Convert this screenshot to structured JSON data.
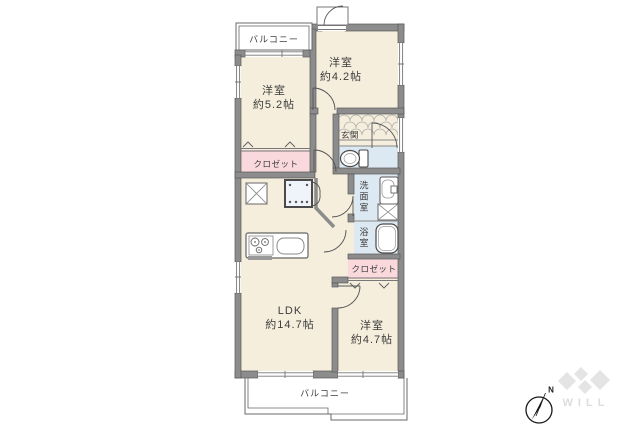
{
  "floor_plan": {
    "balconies": {
      "top": "バルコニー",
      "bottom": "バルコニー"
    },
    "rooms": {
      "bedroom_a": {
        "name": "洋室",
        "area": "約5.2帖"
      },
      "bedroom_b": {
        "name": "洋室",
        "area": "約4.2帖"
      },
      "bedroom_c": {
        "name": "洋室",
        "area": "約4.7帖"
      },
      "ldk": {
        "name": "LDK",
        "area": "約14.7帖"
      },
      "entrance": {
        "name": "玄関"
      },
      "washroom": {
        "name": "洗面室"
      },
      "bathroom": {
        "name": "浴室"
      }
    },
    "closets": {
      "bedroom_a_closet": "クロゼット",
      "bedroom_c_closet": "クロゼット"
    },
    "compass": {
      "north_label": "N"
    },
    "watermark": {
      "text": "WILL"
    },
    "colors": {
      "room_floor": "#f5eedd",
      "closet_pink": "#f9d9db",
      "wet_area_blue": "#dce8f2",
      "wall_gray": "#8c8c8c",
      "watermark_gray": "#e4e4e4"
    }
  }
}
